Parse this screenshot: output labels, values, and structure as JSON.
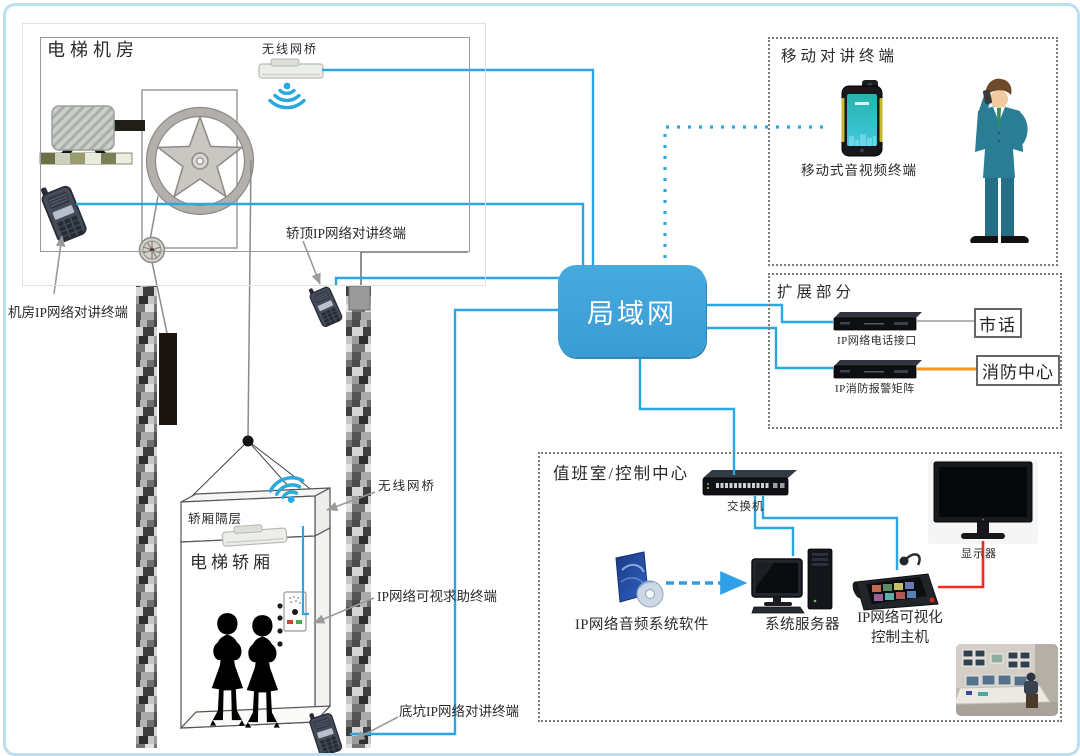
{
  "machine_room": {
    "title": "电梯机房",
    "bridge_label": "无线网桥",
    "handset_label": "机房IP网络对讲终端",
    "cartop_label": "轿顶IP网络对讲终端"
  },
  "shaft": {
    "interlayer_label": "轿厢隔层",
    "car_label": "电梯轿厢",
    "bridge_label": "无线网桥",
    "help_label": "IP网络可视求助终端",
    "pit_label": "底坑IP网络对讲终端"
  },
  "lan": {
    "label": "局域网"
  },
  "mobile": {
    "title": "移动对讲终端",
    "device_label": "移动式音视频终端"
  },
  "expansion": {
    "title": "扩展部分",
    "tel_device_label": "IP网络电话接口",
    "tel_target": "市话",
    "fire_device_label": "IP消防报警矩阵",
    "fire_target": "消防中心"
  },
  "control": {
    "title": "值班室/控制中心",
    "switch_label": "交换机",
    "software_label": "IP网络音频系统软件",
    "server_label": "系统服务器",
    "host_label_line1": "IP网络可视化",
    "host_label_line2": "控制主机",
    "monitor_label": "显示器"
  },
  "colors": {
    "line_blue": "#2aa7e0",
    "lan_fill": "#3fa3d9",
    "orange": "#f8941e",
    "red": "#ee2b1e"
  }
}
